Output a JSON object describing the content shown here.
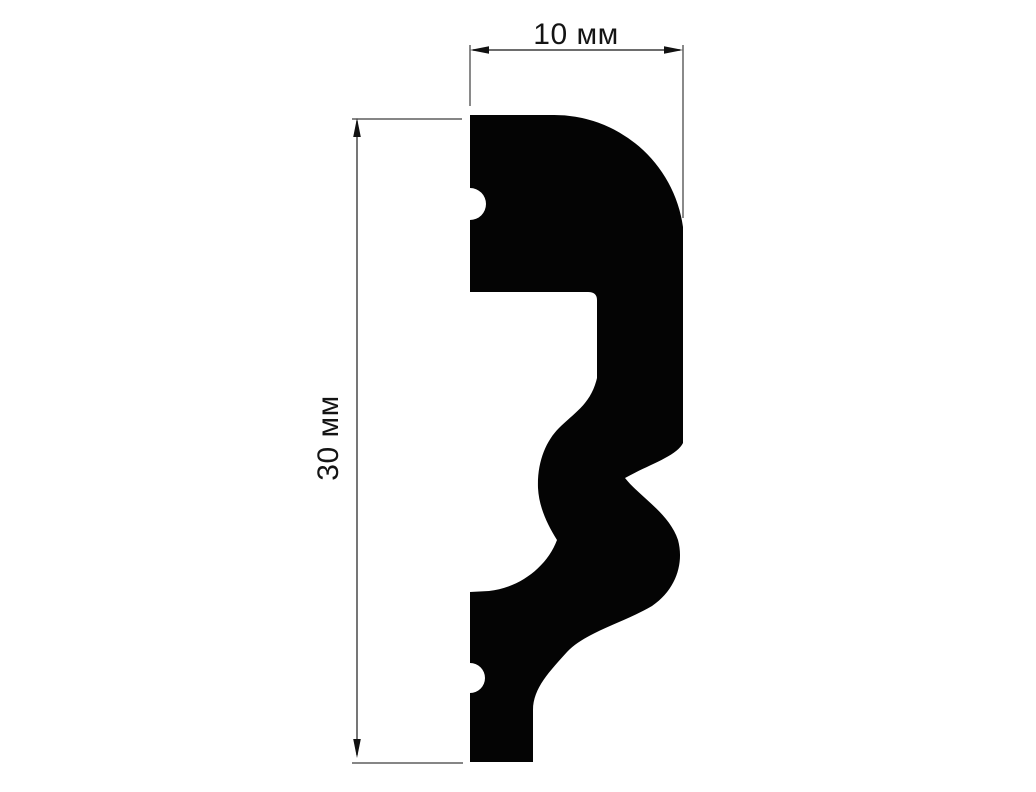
{
  "drawing": {
    "type": "molding-profile-cross-section",
    "width_dimension": {
      "label": "10 мм",
      "value": "10",
      "unit": "мм"
    },
    "height_dimension": {
      "label": "30 мм",
      "value": "30",
      "unit": "мм"
    },
    "colors": {
      "profile_fill": "#040404",
      "dimension_lines": "#3d3d3d",
      "arrowheads": "#111111",
      "label_text": "#141414",
      "background": "#ffffff"
    }
  }
}
